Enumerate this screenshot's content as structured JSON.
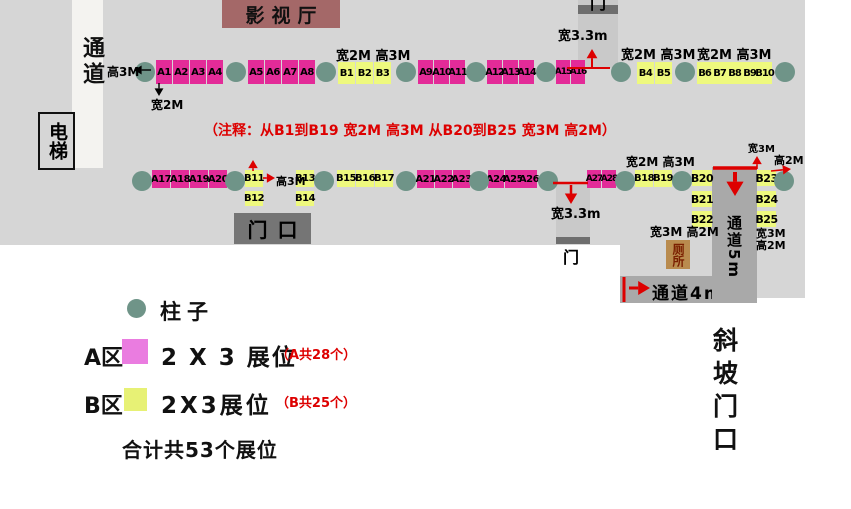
{
  "colors": {
    "hall": "#d6d6d6",
    "corridor-left": "#f4f3f0",
    "corridor": "#a9a9a9",
    "door-strip": "#c9c9c9",
    "door-bar": "#6e6e6e",
    "entrance-box": "#757575",
    "cinema": "#a46868",
    "toilet-bg": "#b98b4e",
    "toilet-text": "#7a1f00",
    "booth-a": "#e32b98",
    "booth-b": "#eef97e",
    "legend-a": "#ea7ce0",
    "legend-b": "#e7f175",
    "column": "#6f9488",
    "red": "#dd0000"
  },
  "areas": {
    "cinema": "影视厅",
    "corridor_left": "通道",
    "elevator": "电梯",
    "entrance": "门口",
    "door_top": "门",
    "door_mid": "门",
    "toilet": "厕所",
    "corridor_5m": "通道5m",
    "corridor_4m": "通道4m",
    "ramp": "斜坡门口"
  },
  "note": "（注释：从B1到B19 宽2M 高3M   从B20到B25 宽3M 高2M）",
  "legend": {
    "column_label": "柱子",
    "a_zone": "A区",
    "a_booth": "2 X 3 展位",
    "a_count": "（A共28个）",
    "b_zone": "B区",
    "b_booth": "2X3展位",
    "b_count": "（B共25个）",
    "total": "合计共53个展位"
  },
  "booths": [
    [
      "A1",
      156,
      60,
      16,
      24
    ],
    [
      "A2",
      173,
      60,
      16,
      24
    ],
    [
      "A3",
      190,
      60,
      16,
      24
    ],
    [
      "A4",
      207,
      60,
      16,
      24
    ],
    [
      "A5",
      248,
      60,
      16,
      24
    ],
    [
      "A6",
      265,
      60,
      16,
      24
    ],
    [
      "A7",
      282,
      60,
      16,
      24
    ],
    [
      "A8",
      299,
      60,
      16,
      24
    ],
    [
      "B1",
      338,
      62,
      17,
      22
    ],
    [
      "B2",
      356,
      62,
      17,
      22
    ],
    [
      "B3",
      374,
      62,
      17,
      22
    ],
    [
      "A9",
      418,
      60,
      15,
      24
    ],
    [
      "A10",
      434,
      60,
      15,
      24
    ],
    [
      "A11",
      450,
      60,
      15,
      24
    ],
    [
      "A12",
      487,
      60,
      15,
      24
    ],
    [
      "A13",
      503,
      60,
      15,
      24
    ],
    [
      "A14",
      519,
      60,
      15,
      24
    ],
    [
      "A15",
      556,
      60,
      14,
      24
    ],
    [
      "A16",
      571,
      60,
      14,
      24
    ],
    [
      "B4",
      637,
      62,
      17,
      22
    ],
    [
      "B5",
      655,
      62,
      17,
      22
    ],
    [
      "B6",
      697,
      62,
      15,
      22
    ],
    [
      "B7",
      712,
      62,
      15,
      22
    ],
    [
      "B8",
      727,
      62,
      15,
      22
    ],
    [
      "B9",
      742,
      62,
      15,
      22
    ],
    [
      "B10",
      757,
      62,
      15,
      22
    ],
    [
      "A17",
      152,
      170,
      18,
      18
    ],
    [
      "A18",
      171,
      170,
      18,
      18
    ],
    [
      "A19",
      190,
      170,
      18,
      18
    ],
    [
      "A20",
      209,
      170,
      18,
      18
    ],
    [
      "B11",
      245,
      170,
      18,
      17
    ],
    [
      "B13",
      296,
      170,
      18,
      17
    ],
    [
      "B12",
      245,
      191,
      18,
      15
    ],
    [
      "B14",
      296,
      191,
      18,
      15
    ],
    [
      "B15",
      337,
      170,
      18,
      17
    ],
    [
      "B16",
      356,
      170,
      18,
      17
    ],
    [
      "B17",
      375,
      170,
      18,
      17
    ],
    [
      "A21",
      417,
      170,
      17,
      18
    ],
    [
      "A22",
      435,
      170,
      17,
      18
    ],
    [
      "A23",
      453,
      170,
      17,
      18
    ],
    [
      "A24",
      488,
      170,
      16,
      18
    ],
    [
      "A25",
      505,
      170,
      16,
      18
    ],
    [
      "A26",
      521,
      170,
      16,
      18
    ],
    [
      "A27",
      587,
      170,
      14,
      18
    ],
    [
      "A28",
      602,
      170,
      14,
      18
    ],
    [
      "B18",
      635,
      170,
      18,
      17
    ],
    [
      "B19",
      654,
      170,
      18,
      17
    ],
    [
      "B20",
      692,
      170,
      20,
      16
    ],
    [
      "B21",
      692,
      191,
      20,
      16
    ],
    [
      "B22",
      692,
      211,
      20,
      16
    ],
    [
      "B23",
      757,
      170,
      19,
      16
    ],
    [
      "B24",
      757,
      191,
      19,
      16
    ],
    [
      "B25",
      757,
      211,
      19,
      16
    ]
  ],
  "columns": [
    [
      135,
      62
    ],
    [
      226,
      62
    ],
    [
      316,
      62
    ],
    [
      396,
      62
    ],
    [
      466,
      62
    ],
    [
      536,
      62
    ],
    [
      611,
      62
    ],
    [
      675,
      62
    ],
    [
      775,
      62
    ],
    [
      132,
      171
    ],
    [
      225,
      171
    ],
    [
      314,
      171
    ],
    [
      396,
      171
    ],
    [
      469,
      171
    ],
    [
      538,
      171
    ],
    [
      615,
      171
    ],
    [
      672,
      171
    ],
    [
      774,
      171
    ]
  ],
  "dim_labels": [
    [
      "高3M",
      107,
      63,
      12
    ],
    [
      "宽2M",
      151,
      96,
      12
    ],
    [
      "宽2M 高3M",
      336,
      45,
      13
    ],
    [
      "宽3.3m",
      558,
      25,
      13
    ],
    [
      "宽2M 高3M",
      621,
      44,
      13
    ],
    [
      "宽2M 高3M",
      697,
      44,
      13
    ],
    [
      "高3M",
      276,
      173,
      11
    ],
    [
      "宽3.3m",
      551,
      203,
      13
    ],
    [
      "宽2M 高3M",
      626,
      153,
      12
    ],
    [
      "宽3M 高2M",
      650,
      223,
      12
    ],
    [
      "宽3M",
      748,
      140,
      10
    ],
    [
      "高2M",
      774,
      152,
      11
    ],
    [
      "宽3M",
      756,
      225,
      11
    ],
    [
      "高2M",
      756,
      237,
      11
    ]
  ],
  "arrows": [
    [
      151,
      70,
      134,
      70,
      "k",
      1.4,
      true
    ],
    [
      159,
      83,
      159,
      96,
      "k",
      1.4,
      true
    ],
    [
      567,
      68,
      610,
      68,
      "r",
      2,
      false
    ],
    [
      592,
      67,
      592,
      49,
      "r",
      2,
      true
    ],
    [
      553,
      183,
      588,
      183,
      "r",
      2.5,
      false
    ],
    [
      571,
      185,
      571,
      204,
      "r",
      2.5,
      true
    ],
    [
      713,
      168,
      757,
      168,
      "r",
      3.5,
      false
    ],
    [
      735,
      172,
      735,
      196,
      "r",
      4,
      true
    ],
    [
      757,
      169,
      757,
      156,
      "r",
      1.6,
      true
    ],
    [
      771,
      171,
      791,
      169,
      "r",
      1.6,
      true
    ],
    [
      263,
      178,
      275,
      178,
      "r",
      1.6,
      true
    ],
    [
      253,
      171,
      253,
      160,
      "r",
      1.6,
      true
    ],
    [
      624,
      277,
      624,
      302,
      "r",
      3,
      false
    ],
    [
      629,
      288,
      650,
      288,
      "r",
      3,
      true
    ]
  ]
}
